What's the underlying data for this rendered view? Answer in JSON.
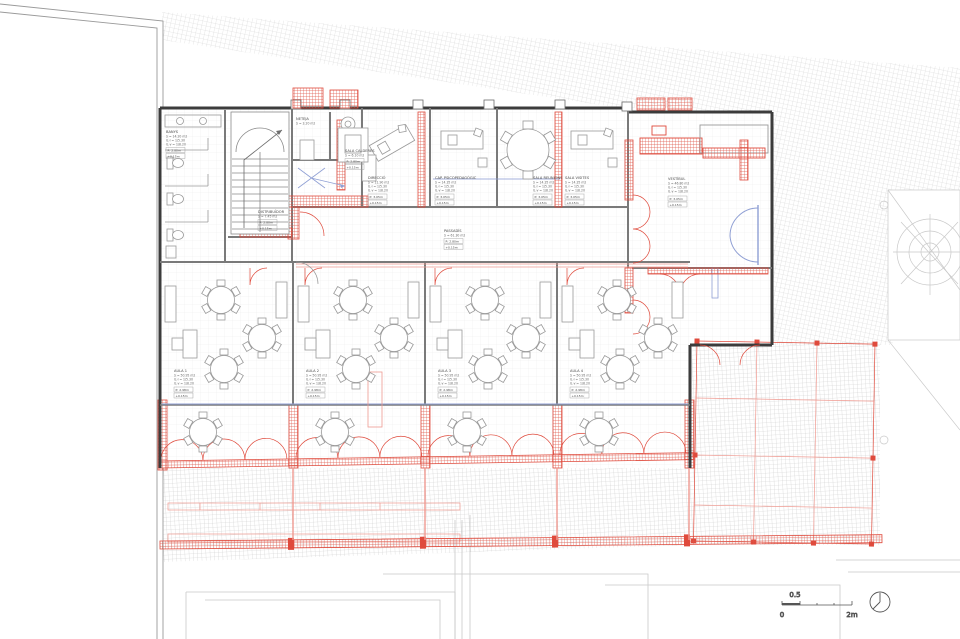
{
  "drawing_type": "architectural floor plan — ground floor, school refurbishment",
  "colors": {
    "new_work_red": "#df4a3c",
    "new_work_red_light": "#f2a49b",
    "glazing_blue": "#8f9fd4",
    "existing_wall_gray": "#3c3c3c",
    "partition_gray": "#7a7a7a",
    "furniture_gray": "#9a9a9a",
    "paving_hatch_gray": "#d6d6d6",
    "floor_tile_gray": "#ececec",
    "context_faint_gray": "#c9c9c9"
  },
  "scale_bar": {
    "zero": "0",
    "half": "0.5",
    "two": "2m"
  },
  "rooms": [
    {
      "name": "BANYS",
      "area": "S = 14.20 m2",
      "il1": "IL·l = 1/5.30",
      "il2": "IL·v = 1/8.20",
      "p": "P: 2.80m",
      "lvl": "+0.15m"
    },
    {
      "name": "SALA CALDERES",
      "area": "S = 6.10 m2",
      "il1": "IL·l = 1/5.30",
      "il2": "IL·v = 1/8.20",
      "p": "P: 2.80m",
      "lvl": "+0.15m"
    },
    {
      "name": "NETEJA",
      "area": "S = 3.20 m2",
      "il1": "IL·l = 1/5.30",
      "il2": "IL·v = 1/8.20",
      "p": "P: 2.80m",
      "lvl": "+0.15m"
    },
    {
      "name": "DISTRIBUÏDOR",
      "area": "S = 7.45 m2",
      "il1": "IL·l = 1/5.30",
      "il2": "IL·v = 1/8.20",
      "p": "P: 2.80m",
      "lvl": "+0.15m"
    },
    {
      "name": "PASSADÍS",
      "area": "S = 61.30 m2",
      "il1": "IL·l = 1/5.30",
      "il2": "IL·v = 1/8.20",
      "p": "P: 2.80m",
      "lvl": "+0.15m"
    },
    {
      "name": "DIRECCIÓ",
      "area": "S = 11.90 m2",
      "il1": "IL·l = 1/5.30",
      "il2": "IL·v = 1/8.20",
      "p": "P: 3.05m",
      "lvl": "+0.15m"
    },
    {
      "name": "CAP. PSICOPEDAGÒGIC",
      "area": "S = 14.35 m2",
      "il1": "IL·l = 1/5.30",
      "il2": "IL·v = 1/8.20",
      "p": "P: 3.05m",
      "lvl": "+0.15m"
    },
    {
      "name": "SALA REUNIONS",
      "area": "S = 14.35 m2",
      "il1": "IL·l = 1/5.30",
      "il2": "IL·v = 1/8.20",
      "p": "P: 3.05m",
      "lvl": "+0.15m"
    },
    {
      "name": "SALA VISITES",
      "area": "S = 14.35 m2",
      "il1": "IL·l = 1/5.30",
      "il2": "IL·v = 1/8.20",
      "p": "P: 3.05m",
      "lvl": "+0.15m"
    },
    {
      "name": "VESTÍBUL",
      "area": "S = 46.80 m2",
      "il1": "IL·l = 1/5.30",
      "il2": "IL·v = 1/8.20",
      "p": "P: 3.05m",
      "lvl": "+0.15m"
    },
    {
      "name": "AULA 1",
      "area": "S = 50.95 m2",
      "il1": "IL·l = 1/5.30",
      "il2": "IL·v = 1/8.20",
      "p": "P: 2.98m",
      "lvl": "+0.15m"
    },
    {
      "name": "AULA 2",
      "area": "S = 50.95 m2",
      "il1": "IL·l = 1/5.30",
      "il2": "IL·v = 1/8.20",
      "p": "P: 2.98m",
      "lvl": "+0.15m"
    },
    {
      "name": "AULA 3",
      "area": "S = 50.95 m2",
      "il1": "IL·l = 1/5.30",
      "il2": "IL·v = 1/8.20",
      "p": "P: 2.98m",
      "lvl": "+0.15m"
    },
    {
      "name": "AULA 4",
      "area": "S = 50.95 m2",
      "il1": "IL·l = 1/5.30",
      "il2": "IL·v = 1/8.20",
      "p": "P: 2.98m",
      "lvl": "+0.15m"
    }
  ]
}
